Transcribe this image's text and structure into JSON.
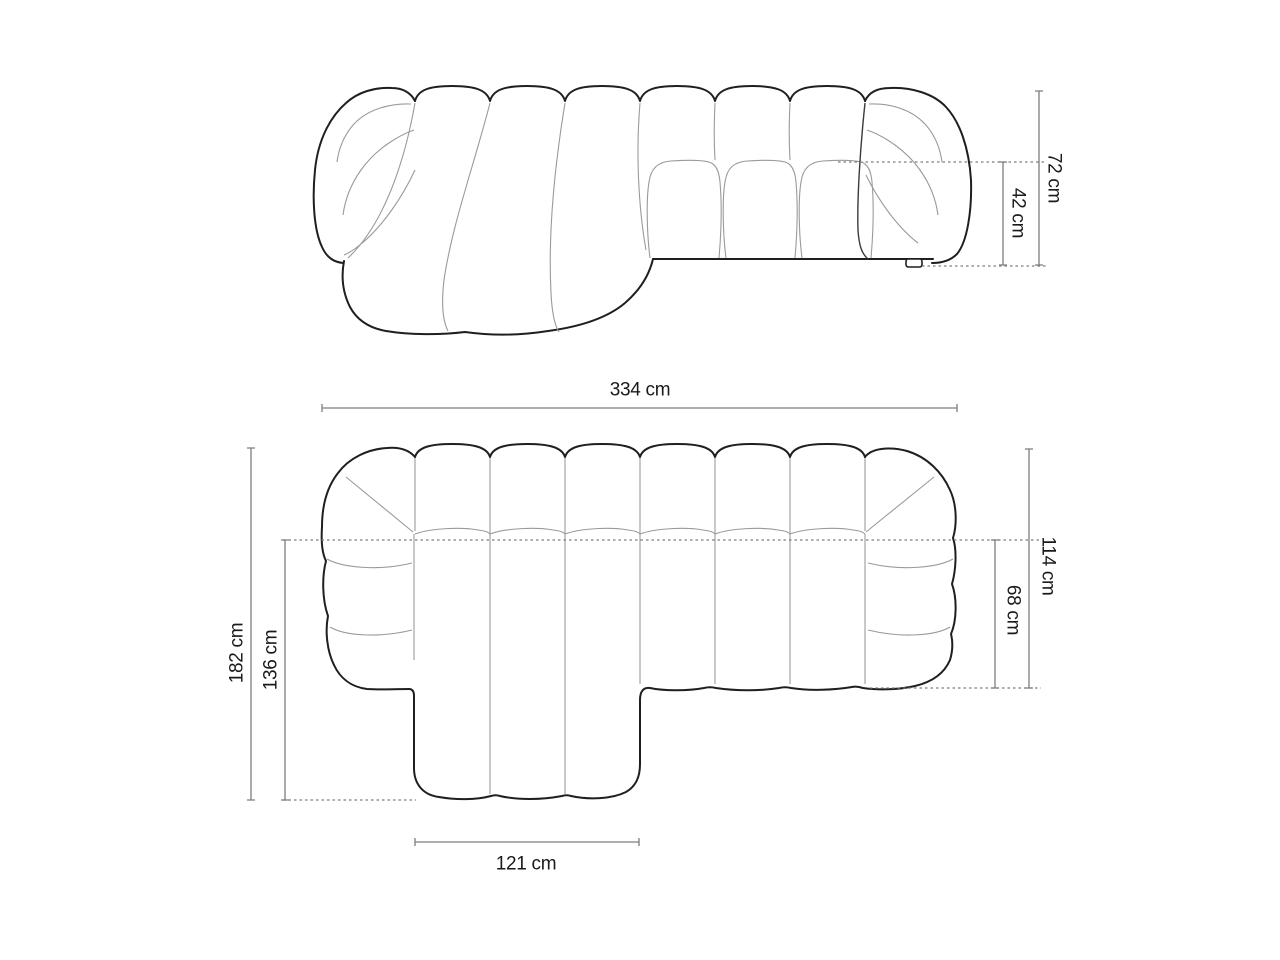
{
  "diagram": {
    "type": "furniture-dimension-diagram",
    "views": {
      "top": "front-elevation",
      "bottom": "top-plan"
    },
    "dimensions": {
      "elevation": {
        "overall_height": "72 cm",
        "seat_height": "42 cm"
      },
      "plan": {
        "overall_width": "334 cm",
        "overall_depth": "182 cm",
        "chaise_length": "136 cm",
        "body_depth": "114 cm",
        "seat_depth": "68 cm",
        "chaise_width": "121 cm"
      }
    },
    "colors": {
      "outline": "#1f1f1f",
      "seam": "#9a9a9a",
      "dimension_line": "#7d7d7d",
      "text": "#1a1a1a",
      "background": "#ffffff"
    }
  }
}
